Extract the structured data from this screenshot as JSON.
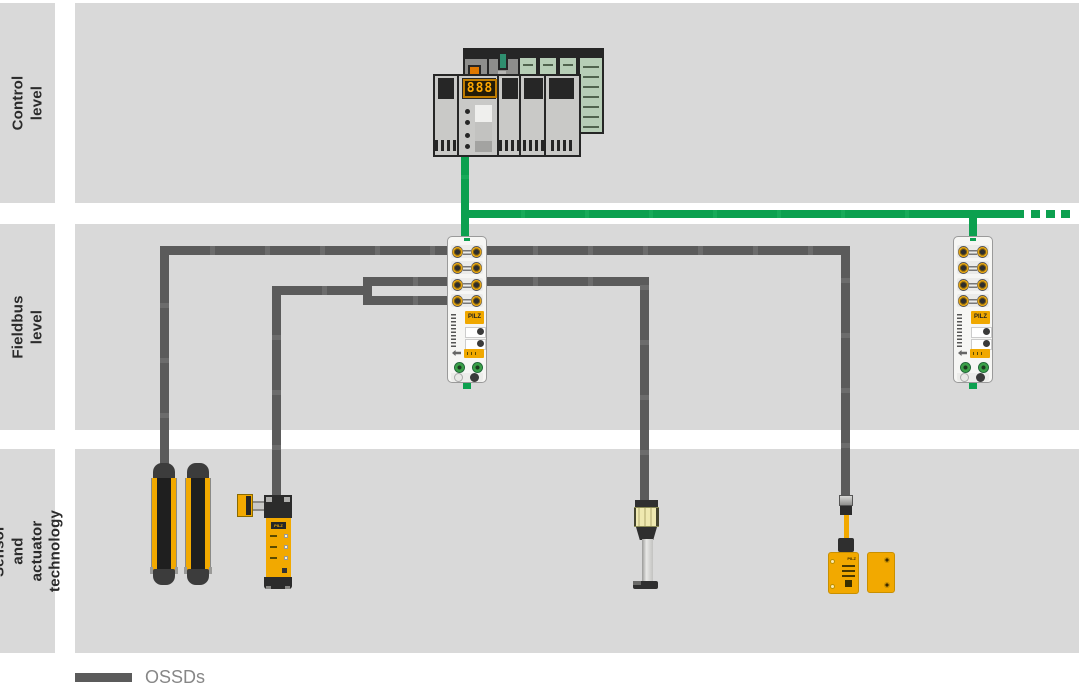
{
  "sidebar": {
    "levels": [
      {
        "label": "Control level"
      },
      {
        "label": "Fieldbus level"
      },
      {
        "label": "Sensor and\nactuator technology"
      }
    ]
  },
  "legend": {
    "ossds_label": "OSSDs"
  },
  "plc": {
    "display_digits": "888"
  },
  "brand": {
    "logo_text": "PILZ"
  },
  "colors": {
    "band_gray": "#d9d9d9",
    "fieldbus_green": "#0ca04f",
    "ossd_cable_gray": "#5b5b5b",
    "device_yellow": "#f2a900"
  },
  "icons": {
    "plc": "plc-controller-rack-icon",
    "fieldbus_module": "decentralized-io-module-icon",
    "light_curtain": "safety-light-curtain-icon",
    "gate_switch": "safety-gate-switch-icon",
    "scanner_column": "safety-sensor-column-icon",
    "magnetic_switch": "magnetic-safety-switch-icon"
  }
}
